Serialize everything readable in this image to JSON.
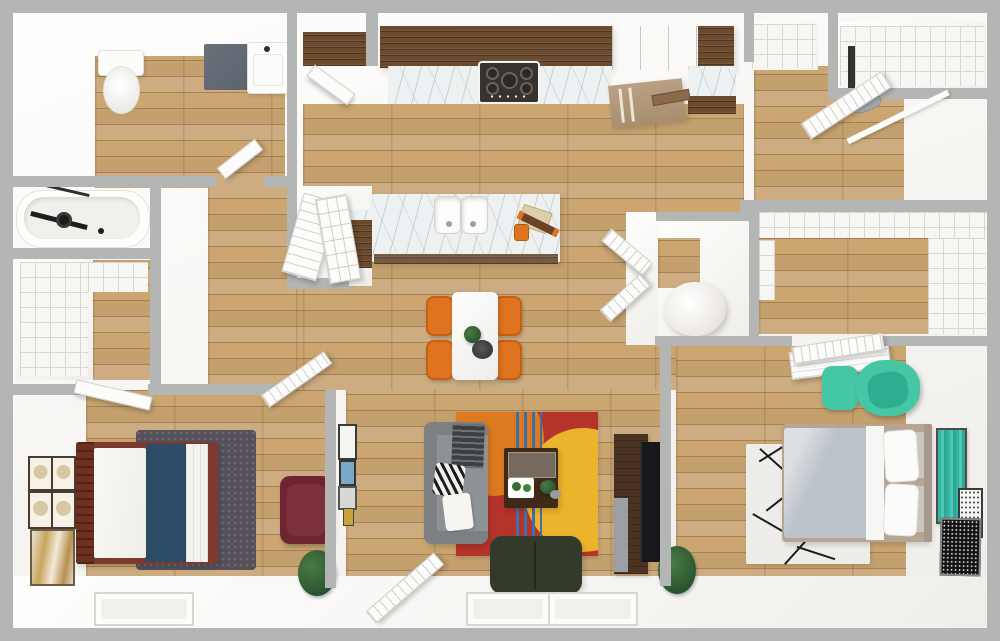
{
  "meta": {
    "type": "3d-rendered-floor-plan-top-down-view",
    "width_px": 1000,
    "height_px": 641,
    "visible_text": "none"
  },
  "colors": {
    "frame_gray": "#b4b5b5",
    "wall_white": "#f6f4f1",
    "wood_base": "#c5a06f",
    "cabinet_wood": "#6b4a2d",
    "marble_white": "#eef1f1",
    "stove_black": "#37322e",
    "fridge_tan": "#b29879",
    "chair_orange": "#df7420",
    "table_white": "#fbfbfa",
    "navy_blanket": "#2c4b66",
    "bed_frame_maroon": "#7b3a2b",
    "rug_shag_gray": "#55505a",
    "sofa_gray": "#8f9295",
    "rug_red": "#b5342a",
    "rug_orange": "#dd7a21",
    "rug_yellow": "#ecb32c",
    "rug_blue": "#3f6fa8",
    "loveseat_green": "#343a2b",
    "console_brown": "#4a3322",
    "tv_black": "#17181a",
    "duvet_gray": "#bdc3ca",
    "bed2_frame_tan": "#b5a591",
    "teal": "#45c6a5",
    "teal_art": "#3cbfae",
    "armchair_maroon": "#6f2531",
    "plant_green": "#2f5c34",
    "rug2_white": "#efedea",
    "shelf_line": "#d9d7d2",
    "mat_gray": "#5c636d"
  },
  "rooms": [
    {
      "name": "bathroom",
      "floor": "wood",
      "furniture": [
        "toilet",
        "vanity-sink",
        "gray-bath-mat",
        "wood-shelf-cabinet",
        "open-door"
      ]
    },
    {
      "name": "bathtub-alcove",
      "floor": "white",
      "furniture": [
        "bathtub",
        "black-shower-fixture",
        "glass-screen"
      ]
    },
    {
      "name": "walk-in-closet-left",
      "floor": "wood-white",
      "furniture": [
        "wire-shelving",
        "open-door"
      ]
    },
    {
      "name": "hallway",
      "floor": "wood",
      "furniture": []
    },
    {
      "name": "hall-closet",
      "floor": "white",
      "furniture": [
        "double-doors",
        "pantry-cabinet"
      ]
    },
    {
      "name": "kitchen",
      "floor": "wood",
      "furniture": [
        "upper-cabinets-left",
        "white-cabinet",
        "upper-cabinets-right",
        "marble-counter",
        "gas-cooktop",
        "refrigerator",
        "side-counter",
        "cutting-board",
        "island-with-double-sink",
        "serving-board",
        "rolling-pin",
        "orange-cup"
      ]
    },
    {
      "name": "dining-area",
      "floor": "wood",
      "furniture": [
        "white-dining-table",
        "orange-chair-1",
        "orange-chair-2",
        "orange-chair-3",
        "orange-chair-4",
        "potted-plant",
        "serving-bowl",
        "bifold-utility-doors"
      ]
    },
    {
      "name": "entry-room-top-right",
      "floor": "wood",
      "furniture": [
        "wire-shelf-closet",
        "open-double-doors",
        "small-appliance"
      ]
    },
    {
      "name": "closet-top-right",
      "floor": "white",
      "furniture": [
        "wire-shelving",
        "garment-rack"
      ]
    },
    {
      "name": "utility-nook",
      "floor": "white",
      "furniture": [
        "water-heater"
      ]
    },
    {
      "name": "walk-in-closet-right",
      "floor": "wood",
      "furniture": [
        "wire-shelving-top",
        "wire-shelving-right",
        "wire-shelving-left"
      ]
    },
    {
      "name": "bedroom-left",
      "floor": "wood",
      "furniture": [
        "bed-maroon-frame-navy-blanket",
        "gray-shag-rug",
        "gallery-frame-1",
        "gallery-frame-2",
        "gallery-frame-3",
        "gallery-frame-4",
        "large-gold-artwork",
        "maroon-armchair",
        "floor-plant",
        "window",
        "entry-door",
        "closet-door"
      ]
    },
    {
      "name": "living-room",
      "floor": "wood",
      "furniture": [
        "gray-sofa",
        "zebra-pillow",
        "white-pillow",
        "dark-throw",
        "multicolor-area-rug",
        "wood-coffee-table",
        "white-tray",
        "table-plants",
        "green-loveseat",
        "media-console",
        "tv",
        "small-wall-frames",
        "front-entry-door",
        "window-1",
        "window-2"
      ]
    },
    {
      "name": "bedroom-right",
      "floor": "wood",
      "furniture": [
        "bed-gray-duvet-tan-frame",
        "white-geometric-rug",
        "white-desk",
        "teal-chair",
        "teal-ottoman",
        "teal-artwork",
        "black-white-artwork",
        "pattern-artwork",
        "floor-plant",
        "slatted-door"
      ]
    }
  ]
}
